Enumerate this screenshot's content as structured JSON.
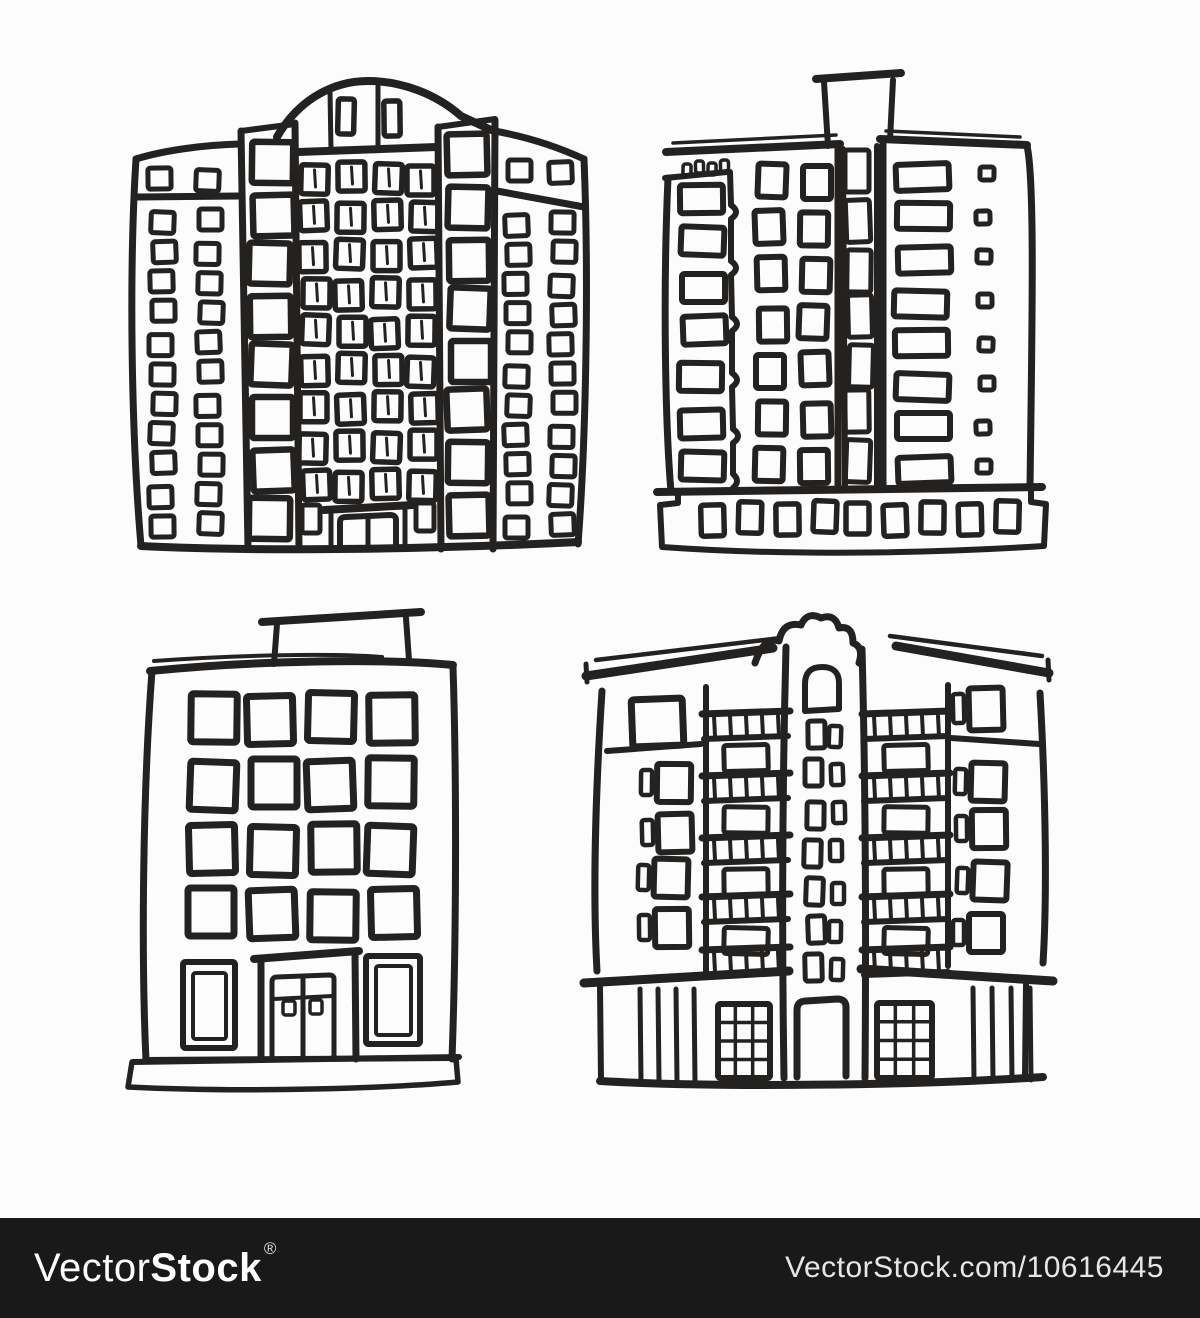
{
  "page": {
    "background": "#fcfcfc",
    "ink": "#242220"
  },
  "watermark": {
    "brand_light": "Vector",
    "brand_bold": "Stock",
    "registered_mark": "®",
    "image_url_text": "VectorStock.com/10616445",
    "bar_color": "#191919",
    "text_color": "#ffffff"
  },
  "figures": [
    {
      "id": "building-1",
      "name": "highrise-arched-crown",
      "description": "Tall hand-sketched panel high-rise with arched crown roof, central window grid, two stair towers and two side wings of small windows",
      "primitives": [
        {
          "t": "path",
          "d": "M277,137 C300,97 336,81 368,81 C402,81 436,94 461,116 L489,129",
          "sw": 8
        },
        {
          "t": "line",
          "x1": 298,
          "y1": 152,
          "x2": 437,
          "y2": 147,
          "sw": 8
        },
        {
          "t": "line",
          "x1": 330,
          "y1": 91,
          "x2": 331,
          "y2": 150,
          "sw": 5
        },
        {
          "t": "line",
          "x1": 378,
          "y1": 86,
          "x2": 378,
          "y2": 148,
          "sw": 5
        },
        {
          "t": "path",
          "d": "M136,159 C165,150 205,145 239,144",
          "sw": 7
        },
        {
          "t": "path",
          "d": "M136,159 C129,270 131,430 141,546",
          "sw": 7
        },
        {
          "t": "line",
          "x1": 138,
          "y1": 197,
          "x2": 238,
          "y2": 196,
          "sw": 7
        },
        {
          "t": "path",
          "d": "M241,131 L248,549",
          "sw": 7
        },
        {
          "t": "path",
          "d": "M295,123 L299,549",
          "sw": 7
        },
        {
          "t": "line",
          "x1": 241,
          "y1": 131,
          "x2": 295,
          "y2": 124,
          "sw": 6
        },
        {
          "t": "path",
          "d": "M438,127 L441,549",
          "sw": 7
        },
        {
          "t": "path",
          "d": "M495,120 L493,549",
          "sw": 7
        },
        {
          "t": "line",
          "x1": 438,
          "y1": 127,
          "x2": 495,
          "y2": 119,
          "sw": 6
        },
        {
          "t": "path",
          "d": "M489,130 C525,136 558,147 584,159",
          "sw": 7
        },
        {
          "t": "path",
          "d": "M584,159 C589,280 586,440 578,544",
          "sw": 7
        },
        {
          "t": "line",
          "x1": 497,
          "y1": 191,
          "x2": 584,
          "y2": 207,
          "sw": 7
        },
        {
          "t": "path",
          "d": "M141,546 C260,552 440,549 578,542",
          "sw": 8
        },
        {
          "t": "line",
          "x1": 324,
          "y1": 510,
          "x2": 413,
          "y2": 505,
          "sw": 8
        },
        {
          "t": "line",
          "x1": 331,
          "y1": 511,
          "x2": 331,
          "y2": 549,
          "sw": 5
        },
        {
          "t": "line",
          "x1": 405,
          "y1": 507,
          "x2": 405,
          "y2": 548,
          "sw": 5
        },
        {
          "t": "path",
          "d": "M340,549 V522 Q340,517 346,517 L390,515 Q396,515 396,520 V548",
          "sw": 6
        },
        {
          "t": "line",
          "x1": 368,
          "y1": 518,
          "x2": 368,
          "y2": 548,
          "sw": 5
        },
        {
          "t": "rect",
          "x": 302,
          "y": 505,
          "w": 18,
          "h": 28,
          "sw": 5
        },
        {
          "t": "rect",
          "x": 416,
          "y": 503,
          "w": 18,
          "h": 28,
          "sw": 5
        },
        {
          "t": "grid",
          "x": 337,
          "y": 99,
          "cols": 2,
          "rows": 1,
          "dx": 45,
          "dy": 0,
          "w": 16,
          "h": 35,
          "sw": 5.5
        },
        {
          "t": "grid",
          "x": 150,
          "y": 170,
          "cols": 2,
          "rows": 1,
          "dx": 47,
          "dy": 0,
          "w": 23,
          "h": 21,
          "sw": 5
        },
        {
          "t": "grid",
          "x": 151,
          "y": 211,
          "cols": 2,
          "rows": 11,
          "dx": 47,
          "dy": 30.4,
          "w": 23,
          "h": 21,
          "sw": 5
        },
        {
          "t": "grid",
          "x": 506,
          "y": 161,
          "cols": 2,
          "rows": 1,
          "dx": 45,
          "dy": 0,
          "w": 23,
          "h": 21,
          "sw": 5
        },
        {
          "t": "grid",
          "x": 506,
          "y": 213,
          "cols": 2,
          "rows": 11,
          "dx": 45,
          "dy": 30.2,
          "w": 23,
          "h": 21,
          "sw": 5
        },
        {
          "t": "grid",
          "x": 251,
          "y": 142,
          "cols": 1,
          "rows": 8,
          "dx": 0,
          "dy": 51,
          "w": 41,
          "h": 41,
          "sw": 6.5
        },
        {
          "t": "grid",
          "x": 449,
          "y": 136,
          "cols": 1,
          "rows": 8,
          "dx": 0,
          "dy": 51,
          "w": 40,
          "h": 41,
          "sw": 6.5
        },
        {
          "t": "grid",
          "x": 301,
          "y": 164,
          "cols": 4,
          "rows": 9,
          "dx": 36,
          "dy": 38.3,
          "w": 27,
          "h": 29,
          "sw": 5.5,
          "style": "double"
        }
      ]
    },
    {
      "id": "building-2",
      "name": "apartment-block-roof-shaft",
      "description": "Sketched apartment block with rooftop elevator box, crenellated left annex, central stair shaft, wide windows and a pedestal base with small windows",
      "primitives": [
        {
          "t": "line",
          "x1": 816,
          "y1": 79,
          "x2": 901,
          "y2": 73,
          "sw": 8
        },
        {
          "t": "line",
          "x1": 824,
          "y1": 82,
          "x2": 828,
          "y2": 146,
          "sw": 6
        },
        {
          "t": "line",
          "x1": 893,
          "y1": 80,
          "x2": 890,
          "y2": 140,
          "sw": 6
        },
        {
          "t": "line",
          "x1": 666,
          "y1": 152,
          "x2": 840,
          "y2": 144,
          "sw": 8
        },
        {
          "t": "line",
          "x1": 673,
          "y1": 143,
          "x2": 836,
          "y2": 135,
          "sw": 3.5
        },
        {
          "t": "line",
          "x1": 880,
          "y1": 139,
          "x2": 1027,
          "y2": 145,
          "sw": 8
        },
        {
          "t": "line",
          "x1": 886,
          "y1": 131,
          "x2": 1020,
          "y2": 137,
          "sw": 3.5
        },
        {
          "t": "line",
          "x1": 665,
          "y1": 178,
          "x2": 727,
          "y2": 172,
          "sw": 6
        },
        {
          "t": "grid",
          "x": 684,
          "y": 162,
          "cols": 4,
          "rows": 1,
          "dx": 11.5,
          "dy": 0,
          "w": 8,
          "h": 12,
          "sw": 3.5
        },
        {
          "t": "path",
          "d": "M668,178 C663,290 665,420 671,492",
          "sw": 7
        },
        {
          "t": "path",
          "d": "M730,172 L731,205 Q741,212 731,219 L731,261 Q741,268 731,275 L732,317 Q742,324 732,331 L732,373 Q742,380 732,387 L733,429 Q743,436 733,443 L733,474 Q741,481 733,488",
          "sw": 6
        },
        {
          "t": "line",
          "x1": 838,
          "y1": 146,
          "x2": 838,
          "y2": 489,
          "sw": 7
        },
        {
          "t": "line",
          "x1": 843,
          "y1": 149,
          "x2": 845,
          "y2": 488,
          "sw": 6
        },
        {
          "t": "line",
          "x1": 877,
          "y1": 146,
          "x2": 877,
          "y2": 488,
          "sw": 6
        },
        {
          "t": "line",
          "x1": 883,
          "y1": 141,
          "x2": 883,
          "y2": 488,
          "sw": 7
        },
        {
          "t": "path",
          "d": "M1027,146 C1035,180 1032,330 1030,488",
          "sw": 7
        },
        {
          "t": "line",
          "x1": 657,
          "y1": 492,
          "x2": 1042,
          "y2": 487,
          "sw": 8
        },
        {
          "t": "path",
          "d": "M678,493 V503 L660,505 L662,547 C800,557 950,552 1044,546 L1046,504 L1031,502 V492",
          "sw": 6
        },
        {
          "t": "grid",
          "x": 681,
          "y": 183,
          "cols": 1,
          "rows": 7,
          "dx": 0,
          "dy": 45,
          "w": 43,
          "h": 28,
          "sw": 6
        },
        {
          "t": "grid",
          "x": 757,
          "y": 164,
          "cols": 2,
          "rows": 7,
          "dx": 44,
          "dy": 47.5,
          "w": 28,
          "h": 33,
          "sw": 6
        },
        {
          "t": "grid",
          "x": 847,
          "y": 152,
          "cols": 1,
          "rows": 7,
          "dx": 0,
          "dy": 48,
          "w": 24,
          "h": 42,
          "sw": 5
        },
        {
          "t": "grid",
          "x": 896,
          "y": 163,
          "cols": 1,
          "rows": 8,
          "dx": 0,
          "dy": 42,
          "w": 53,
          "h": 26,
          "sw": 6,
          "style": "wide"
        },
        {
          "t": "grid",
          "x": 978,
          "y": 168,
          "cols": 1,
          "rows": 8,
          "dx": 0,
          "dy": 42,
          "w": 14,
          "h": 13,
          "sw": 5
        },
        {
          "t": "grid",
          "x": 702,
          "y": 503,
          "cols": 9,
          "rows": 1,
          "dx": 36.5,
          "dy": 0,
          "w": 23,
          "h": 31,
          "sw": 5.5
        }
      ]
    },
    {
      "id": "building-3",
      "name": "five-story-office-block",
      "description": "Sketched five-story block with rooftop penthouse box, four-by-four grid of square windows, twin framed side doors, central double-door entrance and ground plinth",
      "primitives": [
        {
          "t": "line",
          "x1": 262,
          "y1": 622,
          "x2": 421,
          "y2": 612,
          "sw": 8
        },
        {
          "t": "line",
          "x1": 277,
          "y1": 624,
          "x2": 274,
          "y2": 664,
          "sw": 6
        },
        {
          "t": "line",
          "x1": 406,
          "y1": 618,
          "x2": 409,
          "y2": 660,
          "sw": 6
        },
        {
          "t": "path",
          "d": "M150,671 C250,661 380,658 453,665",
          "sw": 8
        },
        {
          "t": "path",
          "d": "M154,661 C240,655 330,653 382,657",
          "sw": 4
        },
        {
          "t": "path",
          "d": "M152,671 C143,790 141,950 146,1061",
          "sw": 7
        },
        {
          "t": "path",
          "d": "M453,667 C457,790 456,950 452,1059",
          "sw": 7
        },
        {
          "t": "line",
          "x1": 146,
          "y1": 1060,
          "x2": 452,
          "y2": 1058,
          "sw": 6
        },
        {
          "t": "rect",
          "x": 183,
          "y": 962,
          "w": 52,
          "h": 86,
          "sw": 6
        },
        {
          "t": "rect",
          "x": 193,
          "y": 973,
          "w": 33,
          "h": 66,
          "sw": 4
        },
        {
          "t": "rect",
          "x": 366,
          "y": 956,
          "w": 54,
          "h": 88,
          "sw": 6
        },
        {
          "t": "rect",
          "x": 376,
          "y": 966,
          "w": 35,
          "h": 69,
          "sw": 4
        },
        {
          "t": "line",
          "x1": 254,
          "y1": 959,
          "x2": 359,
          "y2": 951,
          "sw": 8
        },
        {
          "t": "line",
          "x1": 261,
          "y1": 959,
          "x2": 261,
          "y2": 1059,
          "sw": 7
        },
        {
          "t": "line",
          "x1": 355,
          "y1": 953,
          "x2": 356,
          "y2": 1059,
          "sw": 7
        },
        {
          "t": "path",
          "d": "M272,1058 V982 Q272,977 277,977 L329,975 Q334,975 334,979 V1057",
          "sw": 5
        },
        {
          "t": "line",
          "x1": 303,
          "y1": 978,
          "x2": 303,
          "y2": 1057,
          "sw": 5
        },
        {
          "t": "line",
          "x1": 274,
          "y1": 999,
          "x2": 332,
          "y2": 996,
          "sw": 4
        },
        {
          "t": "rect",
          "x": 283,
          "y": 1001,
          "w": 12,
          "h": 14,
          "sw": 3.5
        },
        {
          "t": "rect",
          "x": 310,
          "y": 1000,
          "w": 12,
          "h": 14,
          "sw": 3.5
        },
        {
          "t": "line",
          "x1": 133,
          "y1": 1062,
          "x2": 459,
          "y2": 1057,
          "sw": 6
        },
        {
          "t": "path",
          "d": "M132,1062 L128,1087 C250,1093 390,1088 458,1082 L456,1059",
          "sw": 5.5
        },
        {
          "t": "grid",
          "x": 189,
          "y": 695,
          "cols": 4,
          "rows": 4,
          "dx": 60,
          "dy": 65,
          "w": 46,
          "h": 48,
          "sw": 7
        }
      ]
    },
    {
      "id": "building-4",
      "name": "apartment-house-central-tower",
      "description": "Sketched apartment house with overhanging eaves, ornate central gable tower with arched window and door, balconies with railings and a colonnaded ground floor",
      "primitives": [
        {
          "t": "path",
          "d": "M586,676 L773,648",
          "sw": 9
        },
        {
          "t": "path",
          "d": "M596,660 L781,638",
          "sw": 4.5
        },
        {
          "t": "line",
          "x1": 586,
          "y1": 664,
          "x2": 587,
          "y2": 682,
          "sw": 5
        },
        {
          "t": "path",
          "d": "M896,646 L1049,673",
          "sw": 9
        },
        {
          "t": "path",
          "d": "M890,636 L1042,656",
          "sw": 4.5
        },
        {
          "t": "line",
          "x1": 1048,
          "y1": 660,
          "x2": 1049,
          "y2": 680,
          "sw": 5
        },
        {
          "t": "path",
          "d": "M755,663 Q764,636 779,641 Q783,621 801,625 Q807,611 821,618 Q835,613 839,628 Q853,625 853,643 Q864,647 859,663",
          "sw": 7
        },
        {
          "t": "path",
          "d": "M786,647 C782,800 782,950 784,1078",
          "sw": 7
        },
        {
          "t": "path",
          "d": "M862,649 C866,800 866,950 865,1078",
          "sw": 7
        },
        {
          "t": "path",
          "d": "M602,691 C595,800 593,900 597,971",
          "sw": 7
        },
        {
          "t": "path",
          "d": "M1040,693 C1046,800 1047,900 1043,963",
          "sw": 7
        },
        {
          "t": "line",
          "x1": 706,
          "y1": 687,
          "x2": 706,
          "y2": 974,
          "sw": 6
        },
        {
          "t": "line",
          "x1": 948,
          "y1": 685,
          "x2": 948,
          "y2": 966,
          "sw": 6
        },
        {
          "t": "line",
          "x1": 607,
          "y1": 751,
          "x2": 701,
          "y2": 744,
          "sw": 6
        },
        {
          "t": "line",
          "x1": 951,
          "y1": 738,
          "x2": 1039,
          "y2": 744,
          "sw": 6
        },
        {
          "t": "line",
          "x1": 584,
          "y1": 983,
          "x2": 789,
          "y2": 971,
          "sw": 9
        },
        {
          "t": "line",
          "x1": 861,
          "y1": 969,
          "x2": 1053,
          "y2": 981,
          "sw": 9
        },
        {
          "t": "line",
          "x1": 600,
          "y1": 987,
          "x2": 601,
          "y2": 1080,
          "sw": 6
        },
        {
          "t": "line",
          "x1": 1026,
          "y1": 984,
          "x2": 1025,
          "y2": 1077,
          "sw": 6
        },
        {
          "t": "path",
          "d": "M600,1081 C720,1088 920,1085 1043,1077",
          "sw": 8
        },
        {
          "t": "path",
          "d": "M797,1077 V1010 Q797,1001 806,1001 L837,999 Q846,999 846,1007 V1076",
          "sw": 7
        },
        {
          "t": "path",
          "d": "M805,711 V684 Q805,667 822,667 Q839,667 839,683 V709 L805,711",
          "sw": 6
        },
        {
          "t": "hatch",
          "x": 718,
          "y": 1004,
          "w": 52,
          "h": 74
        },
        {
          "t": "hatch",
          "x": 877,
          "y": 1003,
          "w": 55,
          "h": 75
        },
        {
          "t": "posts",
          "x": 640,
          "y": 989,
          "h": 92,
          "n": 4,
          "dx": 18
        },
        {
          "t": "posts",
          "x": 973,
          "y": 988,
          "h": 92,
          "n": 4,
          "dx": 19
        },
        {
          "t": "balcony",
          "x": 707,
          "w": 78,
          "ys": [
            714,
            776,
            838,
            897,
            950
          ],
          "wins": 4
        },
        {
          "t": "balcony",
          "x": 867,
          "w": 78,
          "ys": [
            714,
            776,
            838,
            897,
            950
          ],
          "wins": 4
        },
        {
          "t": "grid",
          "x": 633,
          "y": 697,
          "cols": 1,
          "rows": 1,
          "dx": 0,
          "dy": 0,
          "w": 51,
          "h": 47,
          "sw": 7
        },
        {
          "t": "grid",
          "x": 640,
          "y": 764,
          "cols": 1,
          "rows": 4,
          "dx": 0,
          "dy": 48,
          "w": 34,
          "h": 38,
          "sw": 6,
          "style": "side"
        },
        {
          "t": "grid",
          "x": 955,
          "y": 690,
          "cols": 1,
          "rows": 1,
          "dx": 0,
          "dy": 0,
          "w": 34,
          "h": 42,
          "sw": 6,
          "style": "side"
        },
        {
          "t": "grid",
          "x": 955,
          "y": 762,
          "cols": 1,
          "rows": 4,
          "dx": 0,
          "dy": 50,
          "w": 34,
          "h": 38,
          "sw": 6,
          "style": "side"
        },
        {
          "t": "grid",
          "x": 806,
          "y": 722,
          "cols": 2,
          "rows": 7,
          "dx": 25,
          "dy": 39,
          "w": 17,
          "h": 27,
          "sw": 5,
          "style": "pair"
        }
      ]
    }
  ]
}
